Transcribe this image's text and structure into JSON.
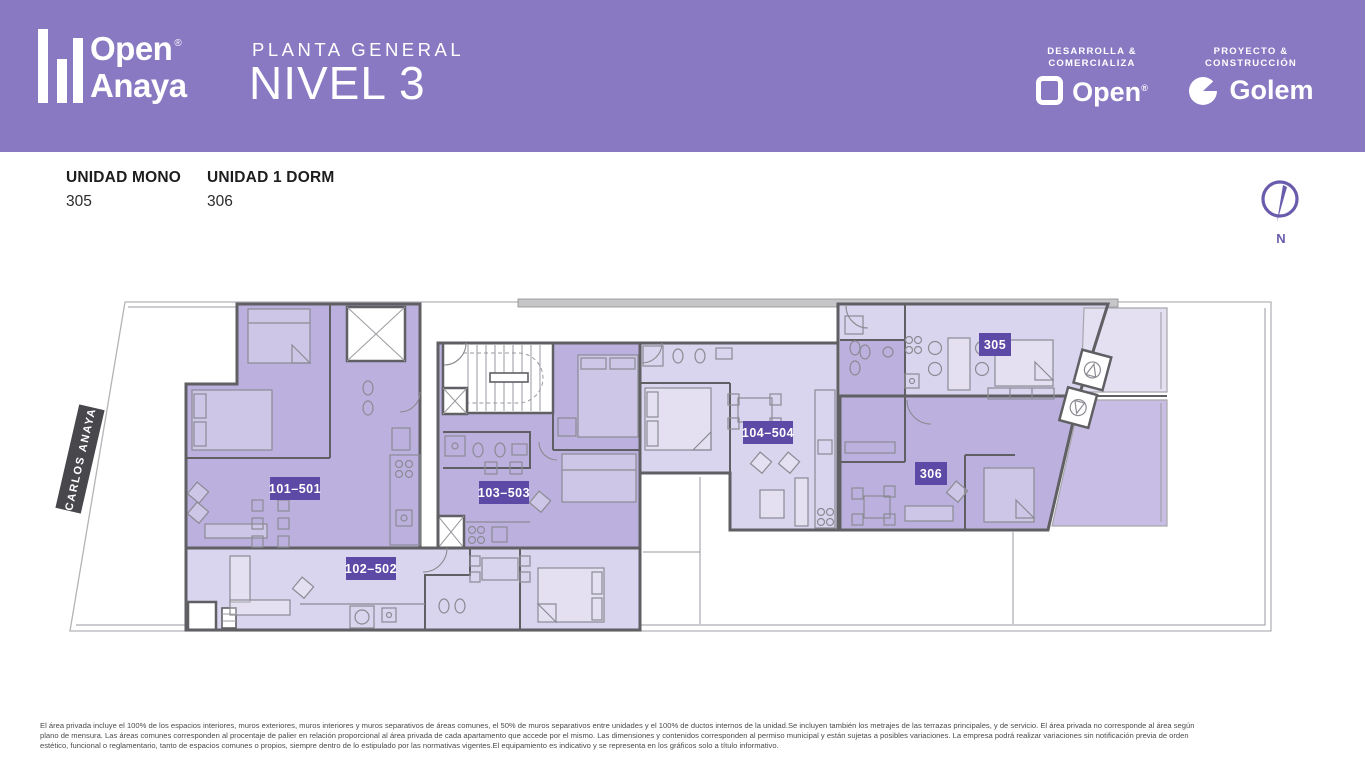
{
  "header": {
    "brand": {
      "line1": "Open",
      "registered": "®",
      "line2": "Anaya"
    },
    "subtitle": "PLANTA GENERAL",
    "title": "NIVEL 3",
    "developer": {
      "label1": "DESARROLLA &",
      "label2": "COMERCIALIZA",
      "brand": "Open",
      "registered": "®"
    },
    "builder": {
      "label1": "PROYECTO &",
      "label2": "CONSTRUCCIÓN",
      "brand": "Golem"
    }
  },
  "legend": [
    {
      "type": "UNIDAD MONO",
      "number": "305"
    },
    {
      "type": "UNIDAD 1 DORM",
      "number": "306"
    }
  ],
  "compass": {
    "label": "N"
  },
  "plan": {
    "street": "CARLOS ANAYA",
    "badges": [
      "101–501",
      "102–502",
      "103–503",
      "104–504",
      "305",
      "306"
    ]
  },
  "footer": {
    "lines": [
      "El área privada incluye el 100% de los espacios interiores, muros exteriores, muros interiores y muros separativos de áreas comunes, el 50% de muros separativos entre unidades y el 100% de ductos internos de la unidad.Se incluyen también los metrajes de las terrazas principales, y de servicio. El área privada no corresponde al área según",
      "plano de mensura. Las áreas comunes corresponden al procentaje de palier en relación proporcional al área privada de cada apartamento que accede por el mismo. Las dimensiones y contenidos corresponden al permiso municipal y están sujetas a posibles variaciones. La empresa podrá realizar variaciones sin notificación previa de orden",
      "estético, funcional o reglamentario, tanto de espacios comunes o propios, siempre dentro de lo estipulado por las normativas vigentes.El equipamiento es indicativo y se representa en los gráficos solo a título informativo."
    ]
  },
  "colors": {
    "c-header": "#8879C2",
    "c-badge": "#5C4AA6",
    "c-medium": "#BCB1DE",
    "c-light": "#DAD5EE",
    "c-terr-light": "#E4E0F2",
    "c-terr-med": "#C8BEE5",
    "c-wall": "#5F5F64",
    "c-street": "#47474C",
    "c-compass": "#6A5BAD"
  }
}
